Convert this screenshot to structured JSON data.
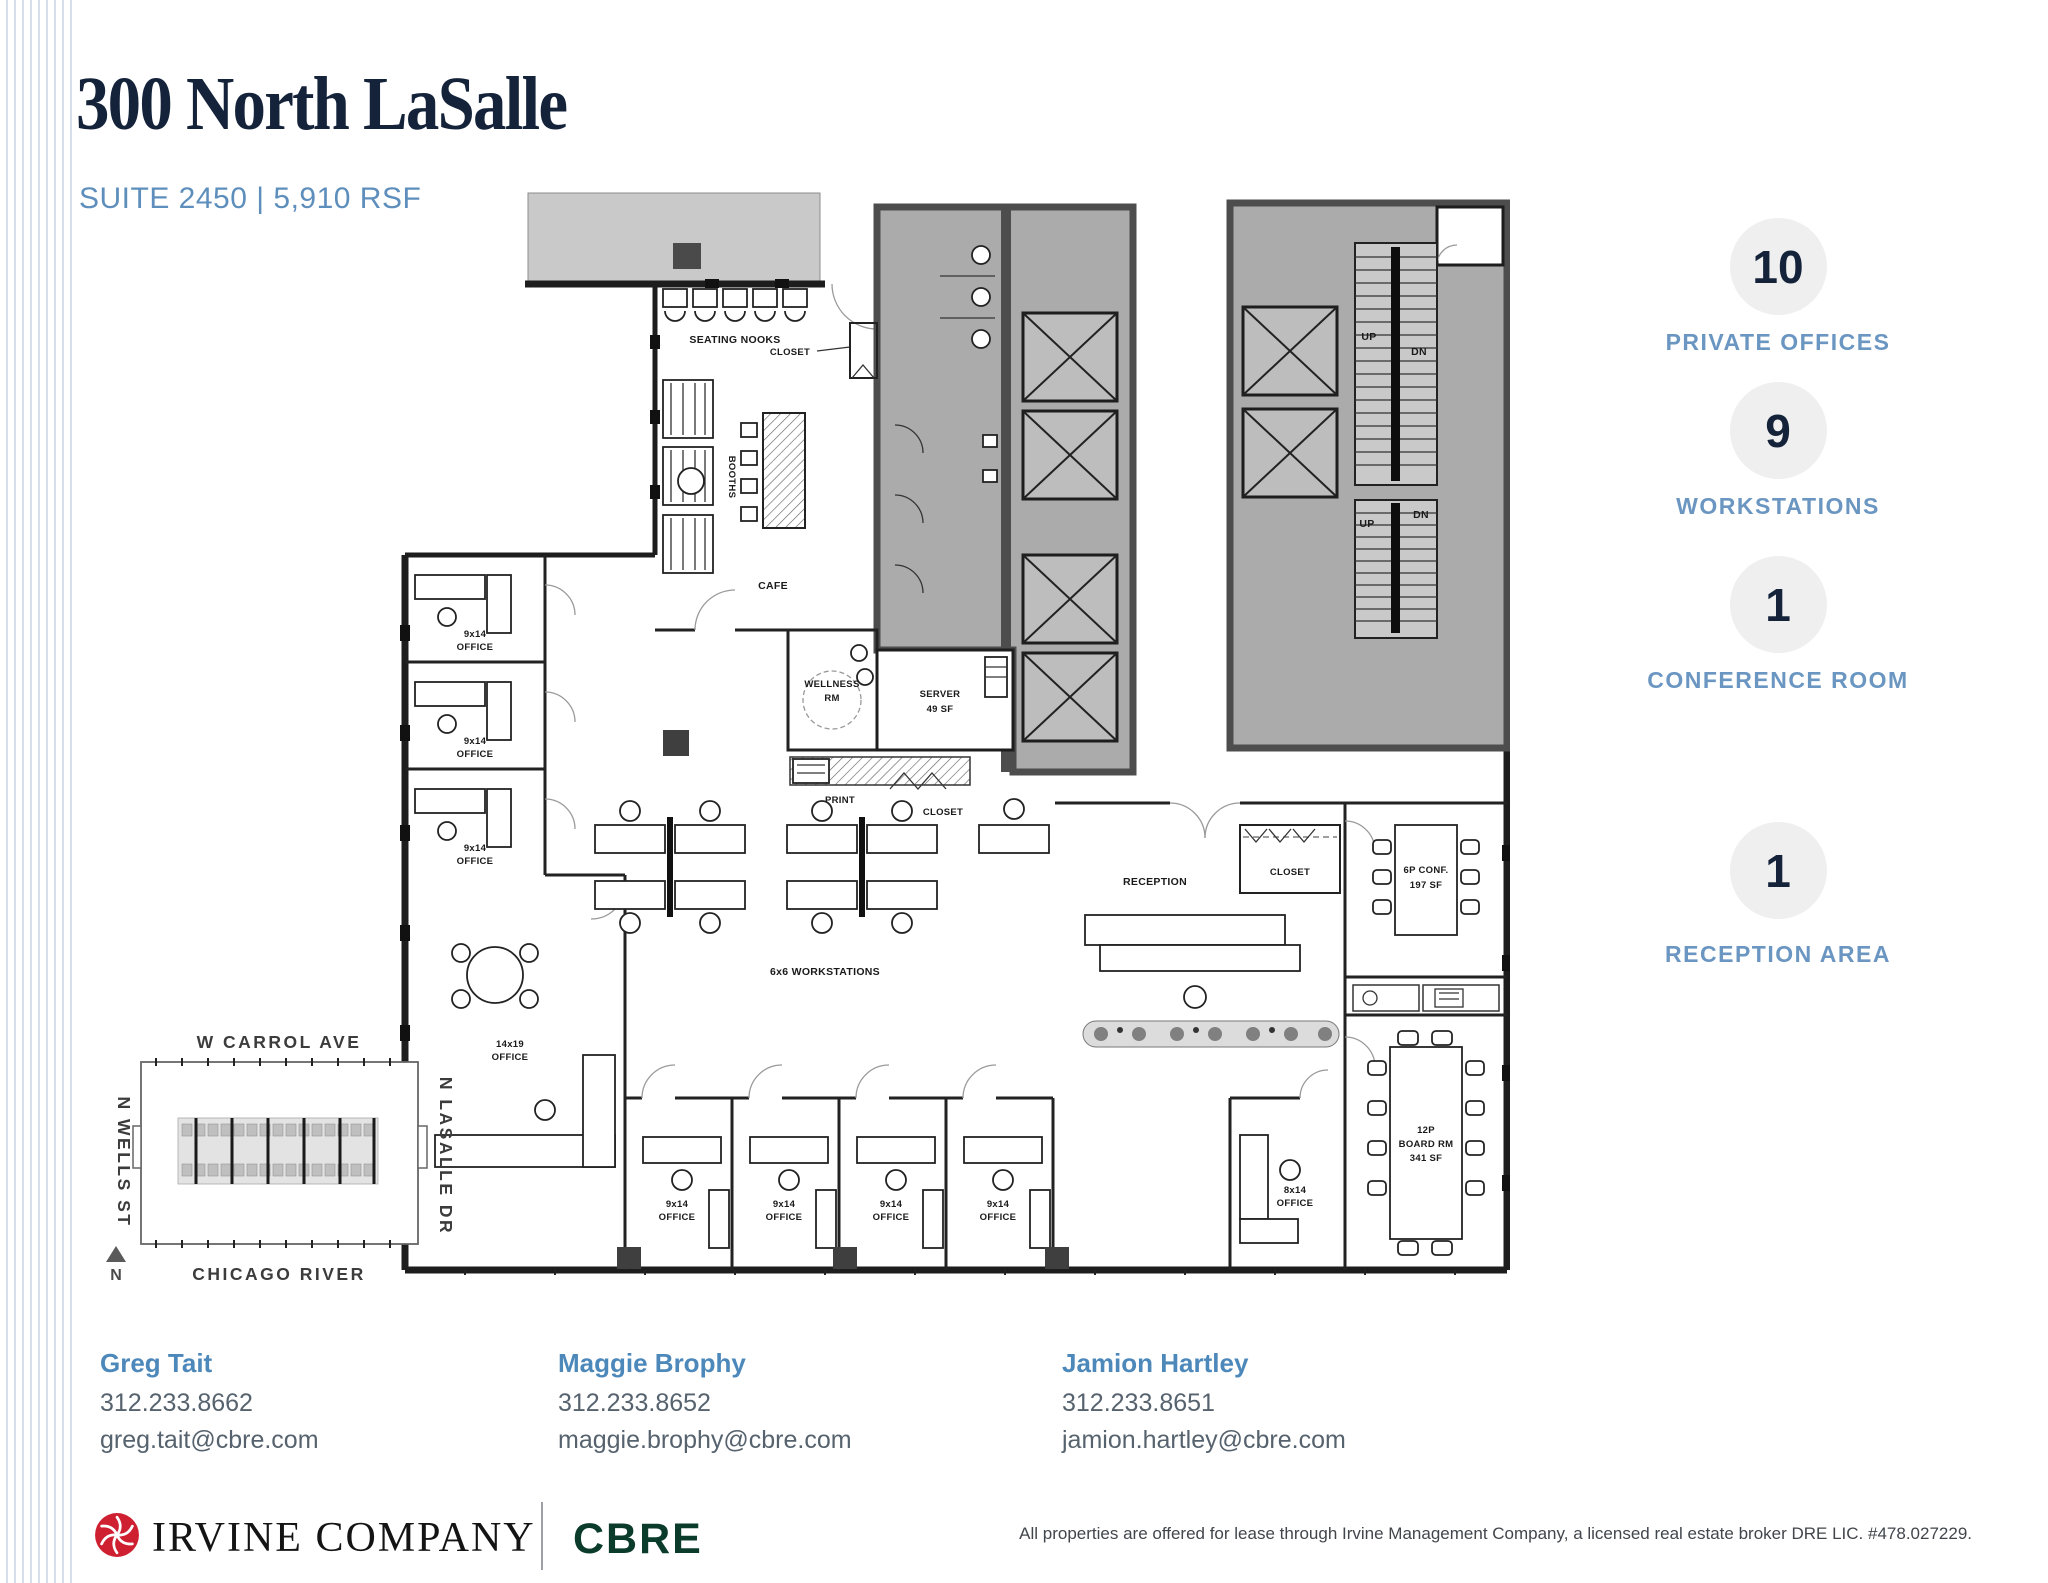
{
  "header": {
    "title": "300 North LaSalle",
    "subtitle": "SUITE 2450 | 5,910 RSF"
  },
  "stats": [
    {
      "value": "10",
      "label": "PRIVATE OFFICES"
    },
    {
      "value": "9",
      "label": "WORKSTATIONS"
    },
    {
      "value": "1",
      "label": "CONFERENCE ROOM"
    },
    {
      "value": "1",
      "label": "RECEPTION AREA"
    }
  ],
  "plan": {
    "labels": {
      "seating_nooks": "SEATING NOOKS",
      "closet": "CLOSET",
      "booths": "BOOTHS",
      "cafe": "CAFE",
      "wellness_line1": "WELLNESS",
      "wellness_line2": "RM",
      "server_line1": "SERVER",
      "server_line2": "49 SF",
      "print": "PRINT",
      "reception": "RECEPTION",
      "conf_line1": "6P CONF.",
      "conf_line2": "197 SF",
      "board_line1": "12P",
      "board_line2": "BOARD RM",
      "board_line3": "341 SF",
      "workstations": "6x6 WORKSTATIONS",
      "office_9x14": "9x14",
      "office_8x14": "8x14",
      "office_14x19": "14x19",
      "office_word": "OFFICE",
      "stair_up": "UP",
      "stair_dn": "DN"
    }
  },
  "map": {
    "street_top": "W CARROL AVE",
    "street_left": "N WELLS ST",
    "street_right": "N LASALLE DR",
    "street_bottom": "CHICAGO RIVER",
    "north": "N"
  },
  "contacts": [
    {
      "name": "Greg Tait",
      "phone": "312.233.8662",
      "email": "greg.tait@cbre.com"
    },
    {
      "name": "Maggie Brophy",
      "phone": "312.233.8652",
      "email": "maggie.brophy@cbre.com"
    },
    {
      "name": "Jamion Hartley",
      "phone": "312.233.8651",
      "email": "jamion.hartley@cbre.com"
    }
  ],
  "footer": {
    "brand_primary": "IRVINE COMPANY",
    "brand_secondary": "CBRE",
    "disclaimer": "All properties are offered for lease through Irvine Management Company, a licensed real estate broker DRE LIC. #478.027229."
  },
  "colors": {
    "navy": "#14233a",
    "accent_blue": "#5e8fbc",
    "stat_label_blue": "#6a96c1",
    "circle_gray": "#efefef",
    "cbre_green": "#0b3b2a",
    "irvine_red": "#ce2030"
  }
}
